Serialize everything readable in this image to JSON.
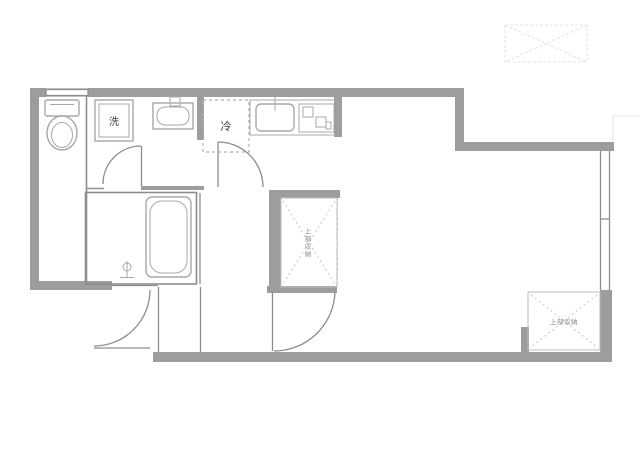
{
  "labels": {
    "washing_machine": "洗",
    "refrigerator": "冷",
    "closet_middle_vertical": "上部収納",
    "closet_bottom_right": "上部収納"
  },
  "colors": {
    "background": "#ffffff",
    "wall": "#9d9d9d",
    "line": "#8d8d8d",
    "fixture": "#a8a8a8",
    "dashed": "#c6c6c6",
    "faint": "#e4e4e4",
    "label_dark": "#3a3a3a",
    "label_light": "#8a8a8a"
  }
}
